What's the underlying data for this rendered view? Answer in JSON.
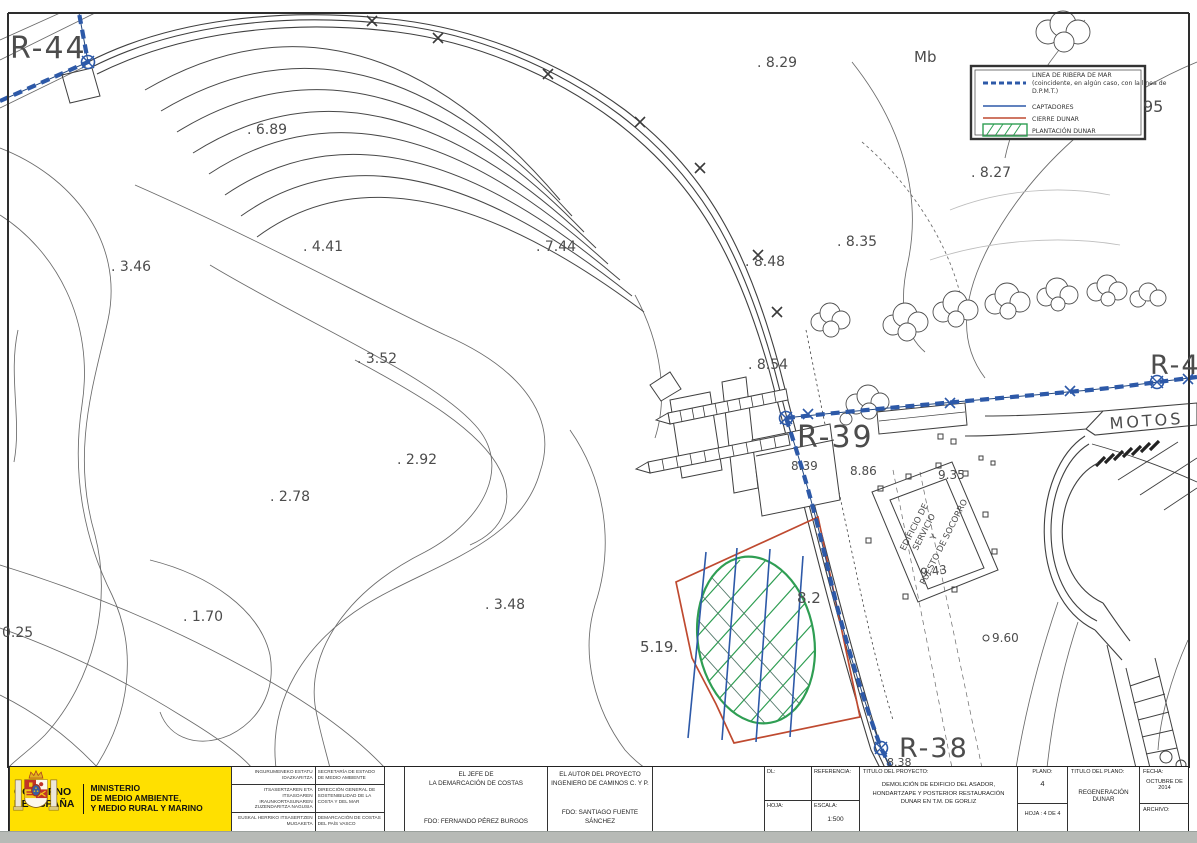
{
  "map": {
    "labels": [
      {
        "text": "R-44",
        "x": 10,
        "y": 58,
        "fs": 30,
        "ls": 2,
        "color": "#5a5a5a",
        "name": "label-r44"
      },
      {
        "text": "R-39",
        "x": 797,
        "y": 447,
        "fs": 30,
        "ls": 2,
        "color": "#5a5a5a",
        "name": "label-r39"
      },
      {
        "text": "R-38",
        "x": 899,
        "y": 757,
        "fs": 27,
        "ls": 2,
        "color": "#5a5a5a",
        "name": "label-r38"
      },
      {
        "text": "R-4",
        "x": 1150,
        "y": 374,
        "fs": 27,
        "ls": 2,
        "color": "#5a5a5a",
        "name": "label-r4"
      },
      {
        "text": "MOTOS",
        "x": 1110,
        "y": 429,
        "fs": 16,
        "ls": 3,
        "rot": -4,
        "color": "#4a4a4a",
        "name": "label-motos"
      },
      {
        "text": "Mb",
        "x": 914,
        "y": 62,
        "fs": 15,
        "name": "label-mb"
      },
      {
        "text": ". 8.29",
        "x": 757,
        "y": 67,
        "fs": 14
      },
      {
        "text": ". 6.89",
        "x": 247,
        "y": 134,
        "fs": 14
      },
      {
        "text": ". 8.27",
        "x": 971,
        "y": 177,
        "fs": 14
      },
      {
        "text": ". 4.41",
        "x": 303,
        "y": 251,
        "fs": 14
      },
      {
        "text": ". 7.44",
        "x": 536,
        "y": 251,
        "fs": 14
      },
      {
        "text": ". 8.48",
        "x": 745,
        "y": 266,
        "fs": 14
      },
      {
        "text": ". 8.35",
        "x": 837,
        "y": 246,
        "fs": 14
      },
      {
        "text": ". 3.46",
        "x": 111,
        "y": 271,
        "fs": 14
      },
      {
        "text": ". 3.52",
        "x": 357,
        "y": 363,
        "fs": 14
      },
      {
        "text": ". 8.54",
        "x": 748,
        "y": 369,
        "fs": 14
      },
      {
        "text": ". 2.92",
        "x": 397,
        "y": 464,
        "fs": 14
      },
      {
        "text": ". 2.78",
        "x": 270,
        "y": 501,
        "fs": 14
      },
      {
        "text": ". 1.70",
        "x": 183,
        "y": 621,
        "fs": 14
      },
      {
        "text": "0.25",
        "x": 2,
        "y": 637,
        "fs": 14
      },
      {
        "text": ". 3.48",
        "x": 485,
        "y": 609,
        "fs": 14
      },
      {
        "text": "5.19.",
        "x": 640,
        "y": 652,
        "fs": 15
      },
      {
        "text": "8.2",
        "x": 797,
        "y": 603,
        "fs": 15
      },
      {
        "text": "8.39",
        "x": 791,
        "y": 470,
        "fs": 12
      },
      {
        "text": "8.86",
        "x": 850,
        "y": 475,
        "fs": 12
      },
      {
        "text": "9.35",
        "x": 938,
        "y": 479,
        "fs": 12
      },
      {
        "text": "9.43",
        "x": 921,
        "y": 577,
        "fs": 12,
        "rot": -8
      },
      {
        "text": "9.60",
        "x": 992,
        "y": 642,
        "fs": 12
      },
      {
        "text": "8.38",
        "x": 887,
        "y": 766,
        "fs": 11
      },
      {
        "text": "95",
        "x": 1143,
        "y": 112,
        "fs": 16
      }
    ],
    "building_label": [
      "EDIFICIO DE",
      "SERVICIO",
      "Y",
      "PUESTO DE SOCORRO"
    ],
    "legend": {
      "ribera_lines": [
        "LINEA DE RIBERA DE MAR",
        "(coincidente, en algún caso, con la línea de",
        "D.P.M.T.)"
      ],
      "captadores": "CAPTADORES",
      "cierre": "CIERRE DUNAR",
      "plantacion": "PLANTACIÓN DUNAR"
    },
    "colors": {
      "ribera_blue": "#2d59a8",
      "cierre_red": "#bf4a30",
      "plantacion_green": "#2f9e53",
      "map_ink": "#454545"
    }
  },
  "titleblock": {
    "ministry": {
      "gobierno": [
        "GOBIERNO",
        "DE ESPAÑA"
      ],
      "ministerio": [
        "MINISTERIO",
        "DE MEDIO AMBIENTE,",
        "Y MEDIO RURAL Y MARINO"
      ]
    },
    "stamps": {
      "rows": [
        {
          "eu": "INGURUMENEKO ESTATU IDAZKARITZA",
          "es": "SECRETARÍA DE ESTADO DE MEDIO AMBIENTE"
        },
        {
          "eu": "ITSASERTZAREN ETA ITSASOAREN IRAUNKORTASUNAREN ZUZENDARITZA NAGUSIA",
          "es": "DIRECCIÓN GENERAL DE SOSTENIBILIDAD DE LA COSTA Y DEL MAR"
        },
        {
          "eu": "EUSKAL HERRIKO ITSASERTZEN MUGAKETA",
          "es": "DEMARCACIÓN DE COSTAS DEL PAÍS VASCO"
        }
      ]
    },
    "firma1": {
      "line1": "EL JEFE DE",
      "line2": "LA DEMARCACIÓN DE COSTAS",
      "fdo": "FDO: FERNANDO PÉREZ BURGOS"
    },
    "firma2": {
      "line1": "EL AUTOR DEL PROYECTO",
      "line2": "INGENIERO DE CAMINOS C. Y P.",
      "fdo": "FDO: SANTIAGO FUENTE SÁNCHEZ"
    },
    "ref": {
      "dl": "DL:",
      "referencia": "REFERENCIA:",
      "hoja": "HOJA:",
      "escala": "ESCALA:",
      "escala_value": "1:500"
    },
    "proyecto": {
      "label": "TITULO DEL PROYECTO:",
      "line1": "DEMOLICIÓN DE EDIFICIO DEL ASADOR,",
      "line2": "HONDARTZAPE Y POSTERIOR RESTAURACIÓN",
      "line3": "DUNAR EN T.M. DE GORLIZ"
    },
    "plano": {
      "label": "PLANO:",
      "numero": "4",
      "hoja": "HOJA : 4 DE 4"
    },
    "plano_titulo": {
      "label": "TITULO DEL PLANO:",
      "value": "REGENERACIÓN DUNAR"
    },
    "fecha": {
      "label": "FECHA:",
      "value": "OCTUBRE DE 2014",
      "archivo": "ARCHIVO:"
    }
  }
}
